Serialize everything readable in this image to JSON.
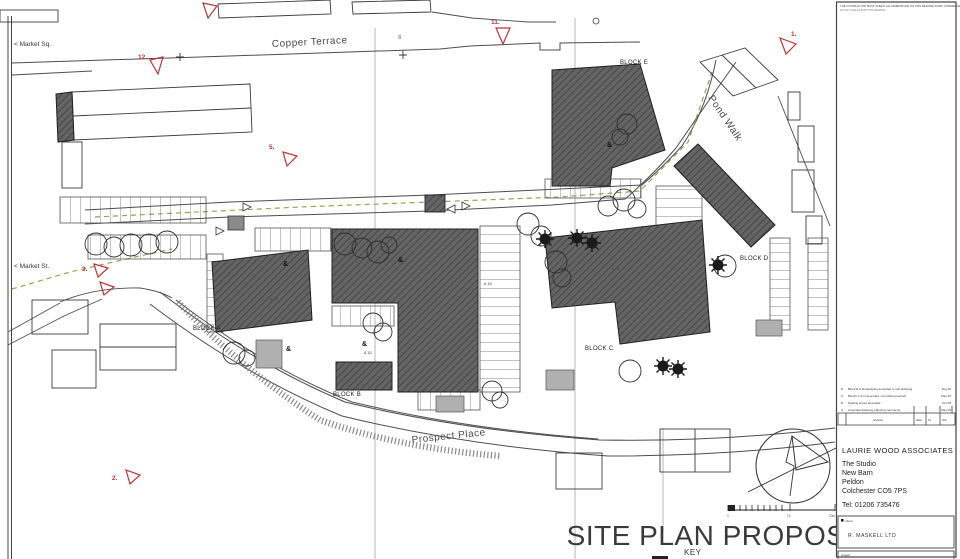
{
  "colors": {
    "building_fill": "#646464",
    "building_hatch": "#3e3e3e",
    "marker_red": "#c03434",
    "dashed_olive": "#9aa04e",
    "road_line": "#4d4d4d",
    "store_gray": "#b0b0b0"
  },
  "plan": {
    "streets": {
      "copper_terrace": "Copper Terrace",
      "pond_walk": "Pond Walk",
      "prospect_place": "Prospect Place"
    },
    "places": {
      "market_sq": "< Market Sq.",
      "market_st": "< Market St."
    },
    "blocks": [
      {
        "label": "BLOCK A"
      },
      {
        "label": "BLOCK B"
      },
      {
        "label": "BLOCK C"
      },
      {
        "label": "BLOCK D"
      },
      {
        "label": "BLOCK E"
      }
    ],
    "markers": [
      {
        "label": "1."
      },
      {
        "label": "2."
      },
      {
        "label": "3."
      },
      {
        "label": "5."
      },
      {
        "label": "11."
      },
      {
        "label": "12."
      }
    ],
    "grid_label": "05",
    "spot_level": "6.15",
    "shrub_symbol": "&"
  },
  "sheet": {
    "title": "SITE PLAN PROPOSED",
    "key_label": "KEY",
    "scale": {
      "start": "0",
      "mid": "10",
      "end": "20m"
    },
    "fine_print": "THE CONTRACTOR MUST CHECK ALL DIMENSIONS ON SITE BEFORE WORK COMMENCES",
    "fine_print_2": "DO NOT SCALE FROM THIS DRAWING"
  },
  "title_block": {
    "revisions": [
      {
        "ref": "D",
        "note": "Block E & landscaping amended to suit planning",
        "date": "Aug 05"
      },
      {
        "ref": "C",
        "note": "Blocks C & D amended, car parking revised",
        "date": "May 05"
      },
      {
        "ref": "B",
        "note": "Parking layout amended",
        "date": "Oct 05"
      },
      {
        "ref": "A",
        "note": "Amended following planning comments",
        "date": "May 05"
      }
    ],
    "rev_header": {
      "label": "revision",
      "date": "date",
      "by": "by",
      "chk": "chk"
    },
    "practice": {
      "name": "LAURIE WOOD ASSOCIATES",
      "address_1": "The Studio",
      "address_2": "New Barn",
      "address_3": "Peldon",
      "address_4": "Colchester CO5 7PS",
      "tel": "Tel: 01206 735476"
    },
    "client_label": "client",
    "client_name": "R. MASKELL LTD",
    "project_label": "project"
  }
}
